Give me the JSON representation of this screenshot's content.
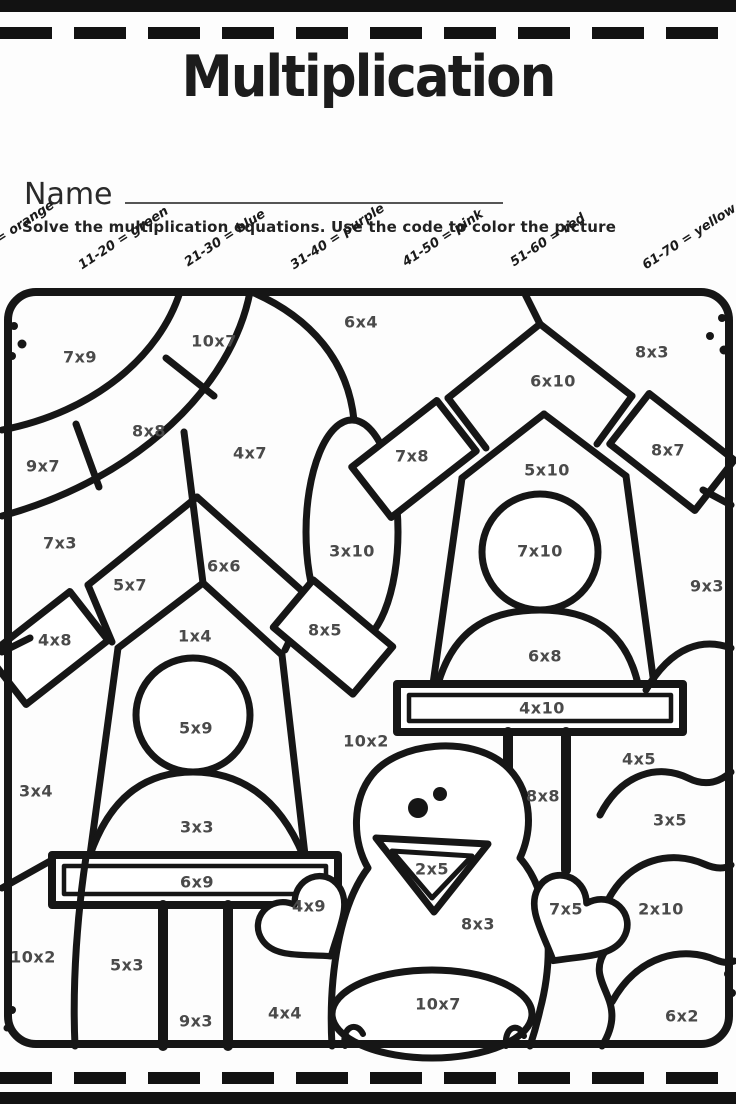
{
  "page": {
    "title": "Multiplication",
    "name_label": "Name",
    "instructions": "Solve the multiplication equations.  Use the code to color the picture"
  },
  "colors": {
    "ink": "#161616",
    "equation_text": "#4a4a4a"
  },
  "color_code": {
    "items": [
      {
        "label": "1-10 = orange"
      },
      {
        "label": "11-20 = green"
      },
      {
        "label": "21-30 = blue"
      },
      {
        "label": "31-40 = purple"
      },
      {
        "label": "41-50 = pink"
      },
      {
        "label": "51-60 = red"
      },
      {
        "label": "61-70 = yellow"
      }
    ]
  },
  "picture": {
    "description": "Coloring picture: two birdhouses on posts, a chick, corner sun arcs and bushes",
    "regions": [
      {
        "label": "7x9",
        "x": 80,
        "y": 357
      },
      {
        "label": "10x7",
        "x": 214,
        "y": 341
      },
      {
        "label": "6x4",
        "x": 361,
        "y": 322
      },
      {
        "label": "6x10",
        "x": 553,
        "y": 381
      },
      {
        "label": "8x3",
        "x": 652,
        "y": 352
      },
      {
        "label": "9x7",
        "x": 43,
        "y": 466
      },
      {
        "label": "8x8",
        "x": 149,
        "y": 431
      },
      {
        "label": "4x7",
        "x": 250,
        "y": 453
      },
      {
        "label": "7x8",
        "x": 412,
        "y": 456
      },
      {
        "label": "8x7",
        "x": 668,
        "y": 450
      },
      {
        "label": "5x10",
        "x": 547,
        "y": 470
      },
      {
        "label": "7x3",
        "x": 60,
        "y": 543
      },
      {
        "label": "5x7",
        "x": 130,
        "y": 585
      },
      {
        "label": "6x6",
        "x": 224,
        "y": 566
      },
      {
        "label": "3x10",
        "x": 352,
        "y": 551
      },
      {
        "label": "7x10",
        "x": 540,
        "y": 551
      },
      {
        "label": "9x3",
        "x": 707,
        "y": 586
      },
      {
        "label": "4x8",
        "x": 55,
        "y": 640
      },
      {
        "label": "1x4",
        "x": 195,
        "y": 636
      },
      {
        "label": "8x5",
        "x": 325,
        "y": 630
      },
      {
        "label": "6x8",
        "x": 545,
        "y": 656
      },
      {
        "label": "4x10",
        "x": 542,
        "y": 708
      },
      {
        "label": "5x9",
        "x": 196,
        "y": 728
      },
      {
        "label": "10x2",
        "x": 366,
        "y": 741
      },
      {
        "label": "3x4",
        "x": 36,
        "y": 791
      },
      {
        "label": "4x5",
        "x": 639,
        "y": 759
      },
      {
        "label": "3x3",
        "x": 197,
        "y": 827
      },
      {
        "label": "8x8",
        "x": 543,
        "y": 796
      },
      {
        "label": "3x5",
        "x": 670,
        "y": 820
      },
      {
        "label": "6x9",
        "x": 197,
        "y": 882
      },
      {
        "label": "4x9",
        "x": 309,
        "y": 906
      },
      {
        "label": "2x5",
        "x": 432,
        "y": 869
      },
      {
        "label": "7x5",
        "x": 566,
        "y": 909
      },
      {
        "label": "2x10",
        "x": 661,
        "y": 909
      },
      {
        "label": "8x3",
        "x": 478,
        "y": 924
      },
      {
        "label": "10x2",
        "x": 33,
        "y": 957
      },
      {
        "label": "5x3",
        "x": 127,
        "y": 965
      },
      {
        "label": "9x3",
        "x": 196,
        "y": 1021
      },
      {
        "label": "4x4",
        "x": 285,
        "y": 1013
      },
      {
        "label": "10x7",
        "x": 438,
        "y": 1004
      },
      {
        "label": "6x2",
        "x": 682,
        "y": 1016
      }
    ]
  }
}
